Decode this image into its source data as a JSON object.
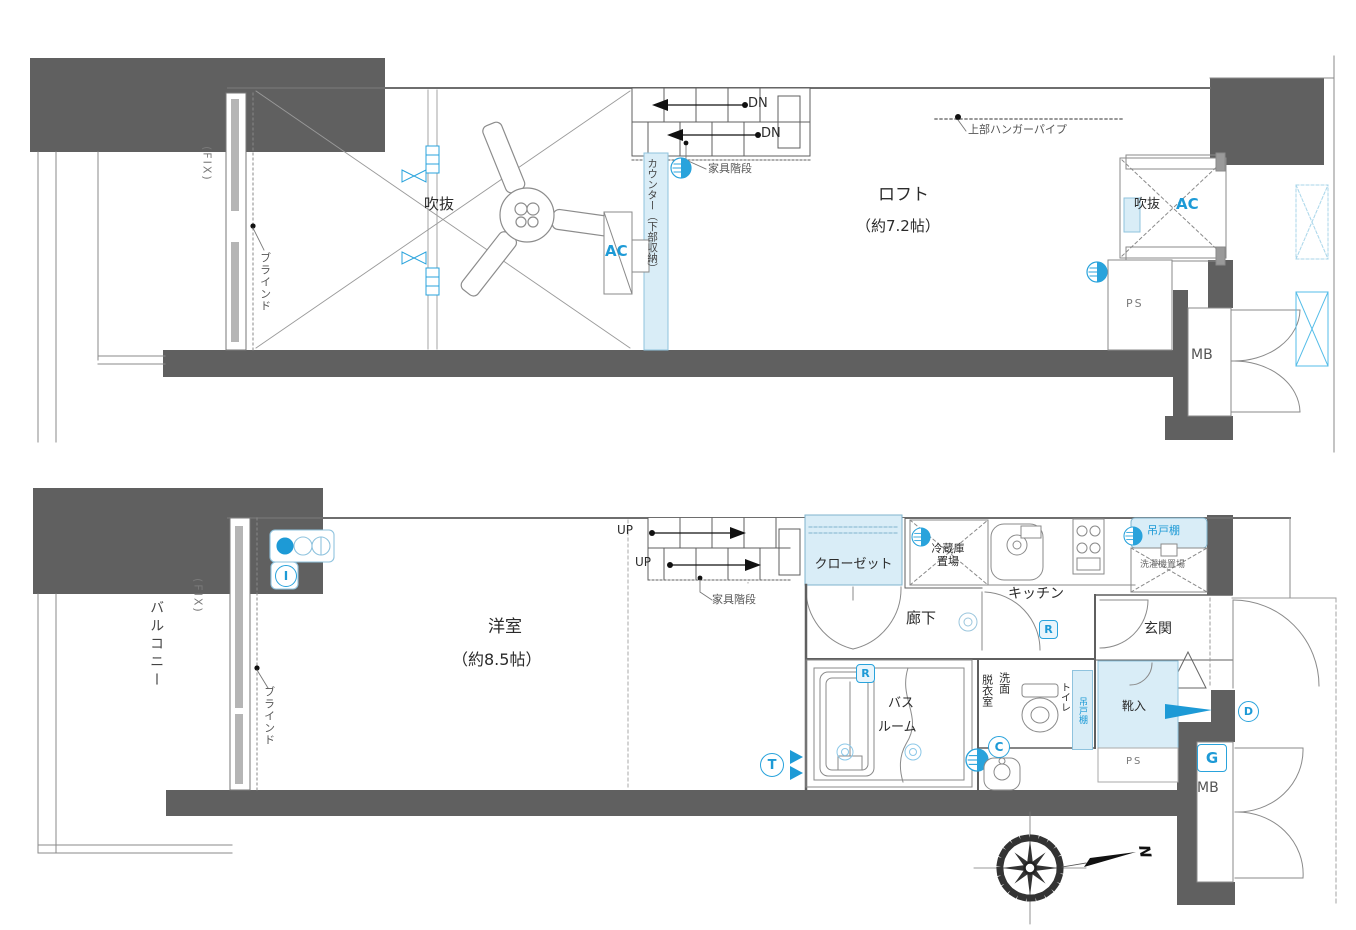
{
  "colors": {
    "wall_dark": "#606060",
    "light_blue_fill": "#d9edf7",
    "blue_accent": "#29a3dc",
    "line_gray": "#777777"
  },
  "upper_floor": {
    "fix": "(FIX)",
    "blind": "ブラインド",
    "void_label": "吹抜",
    "dn_1": "DN",
    "dn_2": "DN",
    "furniture_stairs": "家具階段",
    "counter": "カウンター（下部収納）",
    "ac_unit": "AC",
    "loft_name": "ロフト",
    "loft_size": "（約7.2帖）",
    "hanger_pipe": "上部ハンガーパイプ",
    "void_small": "吹抜",
    "void_small_ac": "AC",
    "ps": "PS",
    "mb": "MB"
  },
  "lower_floor": {
    "balcony": "バルコニー",
    "fix": "(FIX)",
    "blind": "ブラインド",
    "room_name": "洋室",
    "room_size": "（約8.5帖）",
    "up_1": "UP",
    "up_2": "UP",
    "furniture_stairs": "家具階段",
    "closet": "クローゼット",
    "hallway": "廊下",
    "fridge_line1": "冷蔵庫",
    "fridge_line2": "置場",
    "kitchen": "キッチン",
    "hanging_cupboard": "吊戸棚",
    "washer": "洗濯機置場",
    "entrance": "玄関",
    "shoe_box": "靴入",
    "ps": "PS",
    "gas_meter": "G",
    "mb": "MB",
    "bath_line1": "バス",
    "bath_line2": "ルーム",
    "dressing_room": "脱衣室",
    "washing_room": "洗面",
    "toilet": "トイレ",
    "hanging_cupboard_2": "吊戸棚",
    "icons": {
      "r": "R",
      "c": "C",
      "t": "T",
      "d": "D",
      "i": "I"
    }
  },
  "compass": {
    "north": "N"
  }
}
